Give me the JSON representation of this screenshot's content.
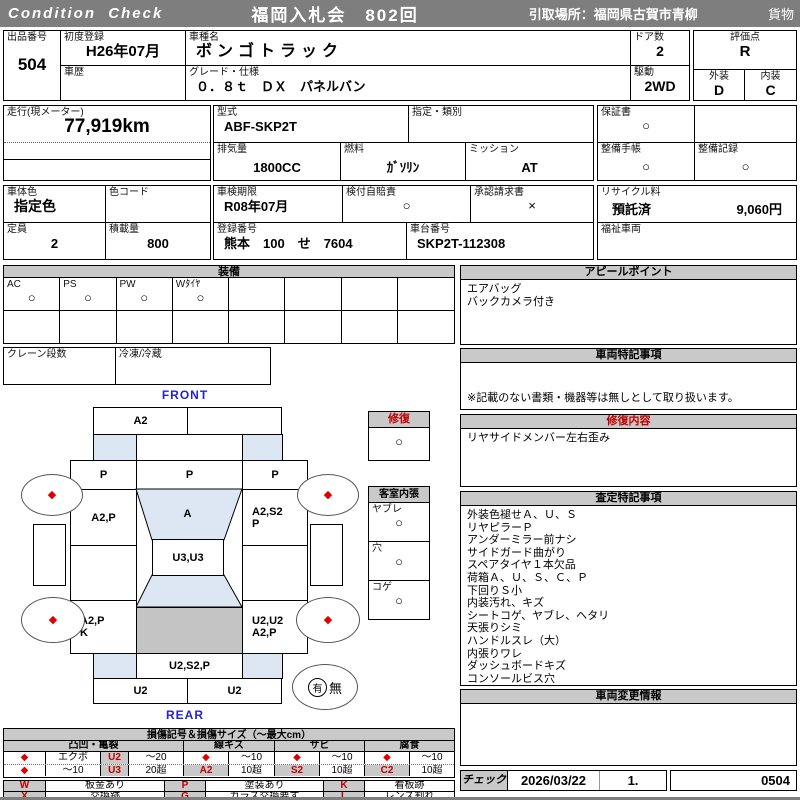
{
  "titlebar": {
    "brand": "Condition  Check",
    "auction": "福岡入札会　802回",
    "pickup": "引取場所：福岡県古賀市青柳",
    "category": "貨物"
  },
  "info": {
    "lot_label": "出品番号",
    "lot_no": "504",
    "first_reg_label": "初度登録",
    "first_reg": "H26年07月",
    "history_label": "車歴",
    "model_label": "車種名",
    "model": "ボンゴトラック",
    "grade_label": "グレード・仕様",
    "grade": "０．８ｔ　ＤＸ　パネルバン",
    "doors_label": "ドア数",
    "doors": "2",
    "drive_label": "駆動",
    "drive": "2WD",
    "score_label": "評価点",
    "score": "R",
    "exterior_label": "外装",
    "exterior": "D",
    "interior_label": "内装",
    "interior": "C",
    "mileage_label": "走行(現メーター)",
    "mileage": "77,919km",
    "model_code_label": "型式",
    "model_code": "ABF-SKP2T",
    "designation_label": "指定・類別",
    "displacement_label": "排気量",
    "displacement": "1800CC",
    "fuel_label": "燃料",
    "fuel": "ｶﾞｿﾘﾝ",
    "mission_label": "ミッション",
    "mission": "AT",
    "warranty_label": "保証書",
    "warranty": "○",
    "maint_book_label": "整備手帳",
    "maint_book": "○",
    "maint_record_label": "整備記録",
    "maint_record": "○",
    "body_color_label": "車体色",
    "body_color": "指定色",
    "color_code_label": "色コード",
    "capacity_label": "定員",
    "capacity": "2",
    "load_label": "積載量",
    "load": "800",
    "inspection_label": "車検期限",
    "inspection": "R08年07月",
    "insurance_label": "検付自賠責",
    "insurance": "○",
    "approval_label": "承認請求書",
    "approval": "×",
    "reg_no_label": "登録番号",
    "reg_no": "熊本　100　せ　7604",
    "chassis_label": "車台番号",
    "chassis": "SKP2T-112308",
    "recycle_label": "リサイクル料",
    "recycle_status": "預託済",
    "recycle_fee": "9,060円",
    "welfare_label": "福祉車両"
  },
  "equipment": {
    "header": "装備",
    "items": [
      {
        "label": "AC",
        "mark": "○"
      },
      {
        "label": "PS",
        "mark": "○"
      },
      {
        "label": "PW",
        "mark": "○"
      },
      {
        "label": "Wﾀｲﾔ",
        "mark": "○"
      },
      {
        "label": "",
        "mark": ""
      },
      {
        "label": "",
        "mark": ""
      },
      {
        "label": "",
        "mark": ""
      },
      {
        "label": "",
        "mark": ""
      }
    ],
    "crane_label": "クレーン段数",
    "reefer_label": "冷凍/冷蔵"
  },
  "map": {
    "front": "FRONT",
    "rear": "REAR",
    "front_bumper_left": "A2",
    "cab_left": "P",
    "windshield": "P",
    "cab_right": "P",
    "door_left": "A2,P",
    "roof": "A",
    "door_right_1": "A2,S2",
    "door_right_2": "P",
    "cab_back": "U3,U3",
    "bed_left_1": "A2,P",
    "bed_left_2": "K",
    "bed_right_1": "U2,U2",
    "bed_right_2": "A2,P",
    "rear_panel": "U2,S2,P",
    "rear_bumper_left": "U2",
    "rear_bumper_right": "U2",
    "wheel_mark": "◆",
    "recycle_yes": "有",
    "recycle_no": "無"
  },
  "repair": {
    "header": "修復",
    "mark": "○"
  },
  "cabin": {
    "header": "客室内張",
    "rows": [
      {
        "label": "ヤブレ",
        "mark": "○"
      },
      {
        "label": "穴",
        "mark": "○"
      },
      {
        "label": "コゲ",
        "mark": "○"
      }
    ]
  },
  "appeal": {
    "header": "アピールポイント",
    "line1": "エアバッグ",
    "line2": "バックカメラ付き"
  },
  "vehicle_notes": {
    "header": "車両特記事項",
    "note": "※記載のない書類・機器等は無しとして取り扱います。"
  },
  "repair_detail": {
    "header": "修復内容",
    "line1": "リヤサイドメンバー左右歪み"
  },
  "assessment": {
    "header": "査定特記事項",
    "lines": [
      "外装色褪せＡ、Ｕ、Ｓ",
      "リヤピラーＰ",
      "アンダーミラー前ナシ",
      "サイドガード曲がり",
      "スペアタイヤ１本欠品",
      "荷箱Ａ、Ｕ、Ｓ、Ｃ、Ｐ",
      "下回りＳ小",
      "内装汚れ、キズ",
      "シートコゲ、ヤブレ、ヘタリ",
      "天張りシミ",
      "ハンドルスレ（大）",
      "内張りワレ",
      "ダッシュボードキズ",
      "コンソールビス穴"
    ]
  },
  "change_info": {
    "header": "車両変更情報"
  },
  "check": {
    "label": "チェック",
    "date": "2026/03/22",
    "num": "1.",
    "code": "0504"
  },
  "legend": {
    "title": "損傷記号＆損傷サイズ（～最大cm）",
    "g1": "凸凹・亀裂",
    "g2": "線キズ",
    "g3": "サビ",
    "g4": "腐食",
    "dia": "◆",
    "dent_r1_name": "エクボ",
    "dent_r1_code": "U2",
    "dent_r1_size": "～20",
    "dent_r2_name": "～10",
    "dent_r2_code": "U3",
    "dent_r2_size": "20超",
    "scratch_r1_size": "～10",
    "scratch_code": "A2",
    "scratch_r2_size": "10超",
    "rust_r1_size": "～10",
    "rust_code": "S2",
    "rust_r2_size": "10超",
    "corr_r1_size": "～10",
    "corr_code": "C2",
    "corr_r2_size": "10超",
    "sym_w": "W",
    "sym_w_desc": "板金あり",
    "sym_p": "P",
    "sym_p_desc": "塗装あり",
    "sym_k": "K",
    "sym_k_desc": "看板跡",
    "sym_x": "X",
    "sym_x_desc": "交換跡",
    "sym_g": "G",
    "sym_g_desc": "ガラス交換要す",
    "sym_l": "L",
    "sym_l_desc": "レンズ割れ"
  },
  "colors": {
    "titlebar_gray": "#7e7e7e",
    "header_gray": "#c9c9c9",
    "accent_red": "#c00000",
    "label_blue": "#2323cc",
    "shade_blue": "#dce7f3",
    "cargo_gray": "#c4c4c4",
    "diamond_red": "#e00000"
  }
}
